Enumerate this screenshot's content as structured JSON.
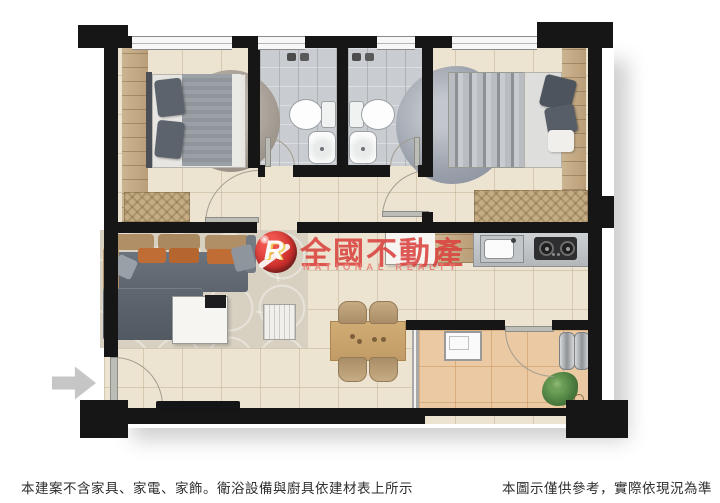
{
  "watermark": {
    "logo_letter": "R",
    "title": "全國不動產",
    "subtitle": "NATIONAL REALTY",
    "brand_red": "#d9423e",
    "subtitle_pink": "#e8837a"
  },
  "captions": {
    "left": "本建案不含家具、家電、家飾。衛浴設備與廚具依建材表上所示",
    "right": "本圖示僅供參考，實際依現況為準"
  },
  "palette": {
    "wall_black": "#161616",
    "floor_beige": "#ece4d1",
    "bathroom_tile_gray": "#c9cdd1",
    "balcony_tan": "#ebc9a2",
    "wood_tan": "#c2a37c",
    "sofa_gray": "#646c76",
    "cushion_orange": "#bf6c35",
    "cushion_tan": "#b08e66",
    "living_rug": "#d8d1c2",
    "kitchen_counter": "#c2c5c8",
    "stove_black": "#2e2e30",
    "plant_green": "#58854a",
    "entrance_arrow_gray": "#c6c6c6"
  },
  "icons": {
    "entrance-arrow": "thick right-pointing arrow (css clip-path)",
    "shower-icon": "pair of dark fixture squares",
    "drain-icon": "small circle outline",
    "stove-burner-icon": "dark circle with ring",
    "faucet-icon": "small dark dot"
  }
}
